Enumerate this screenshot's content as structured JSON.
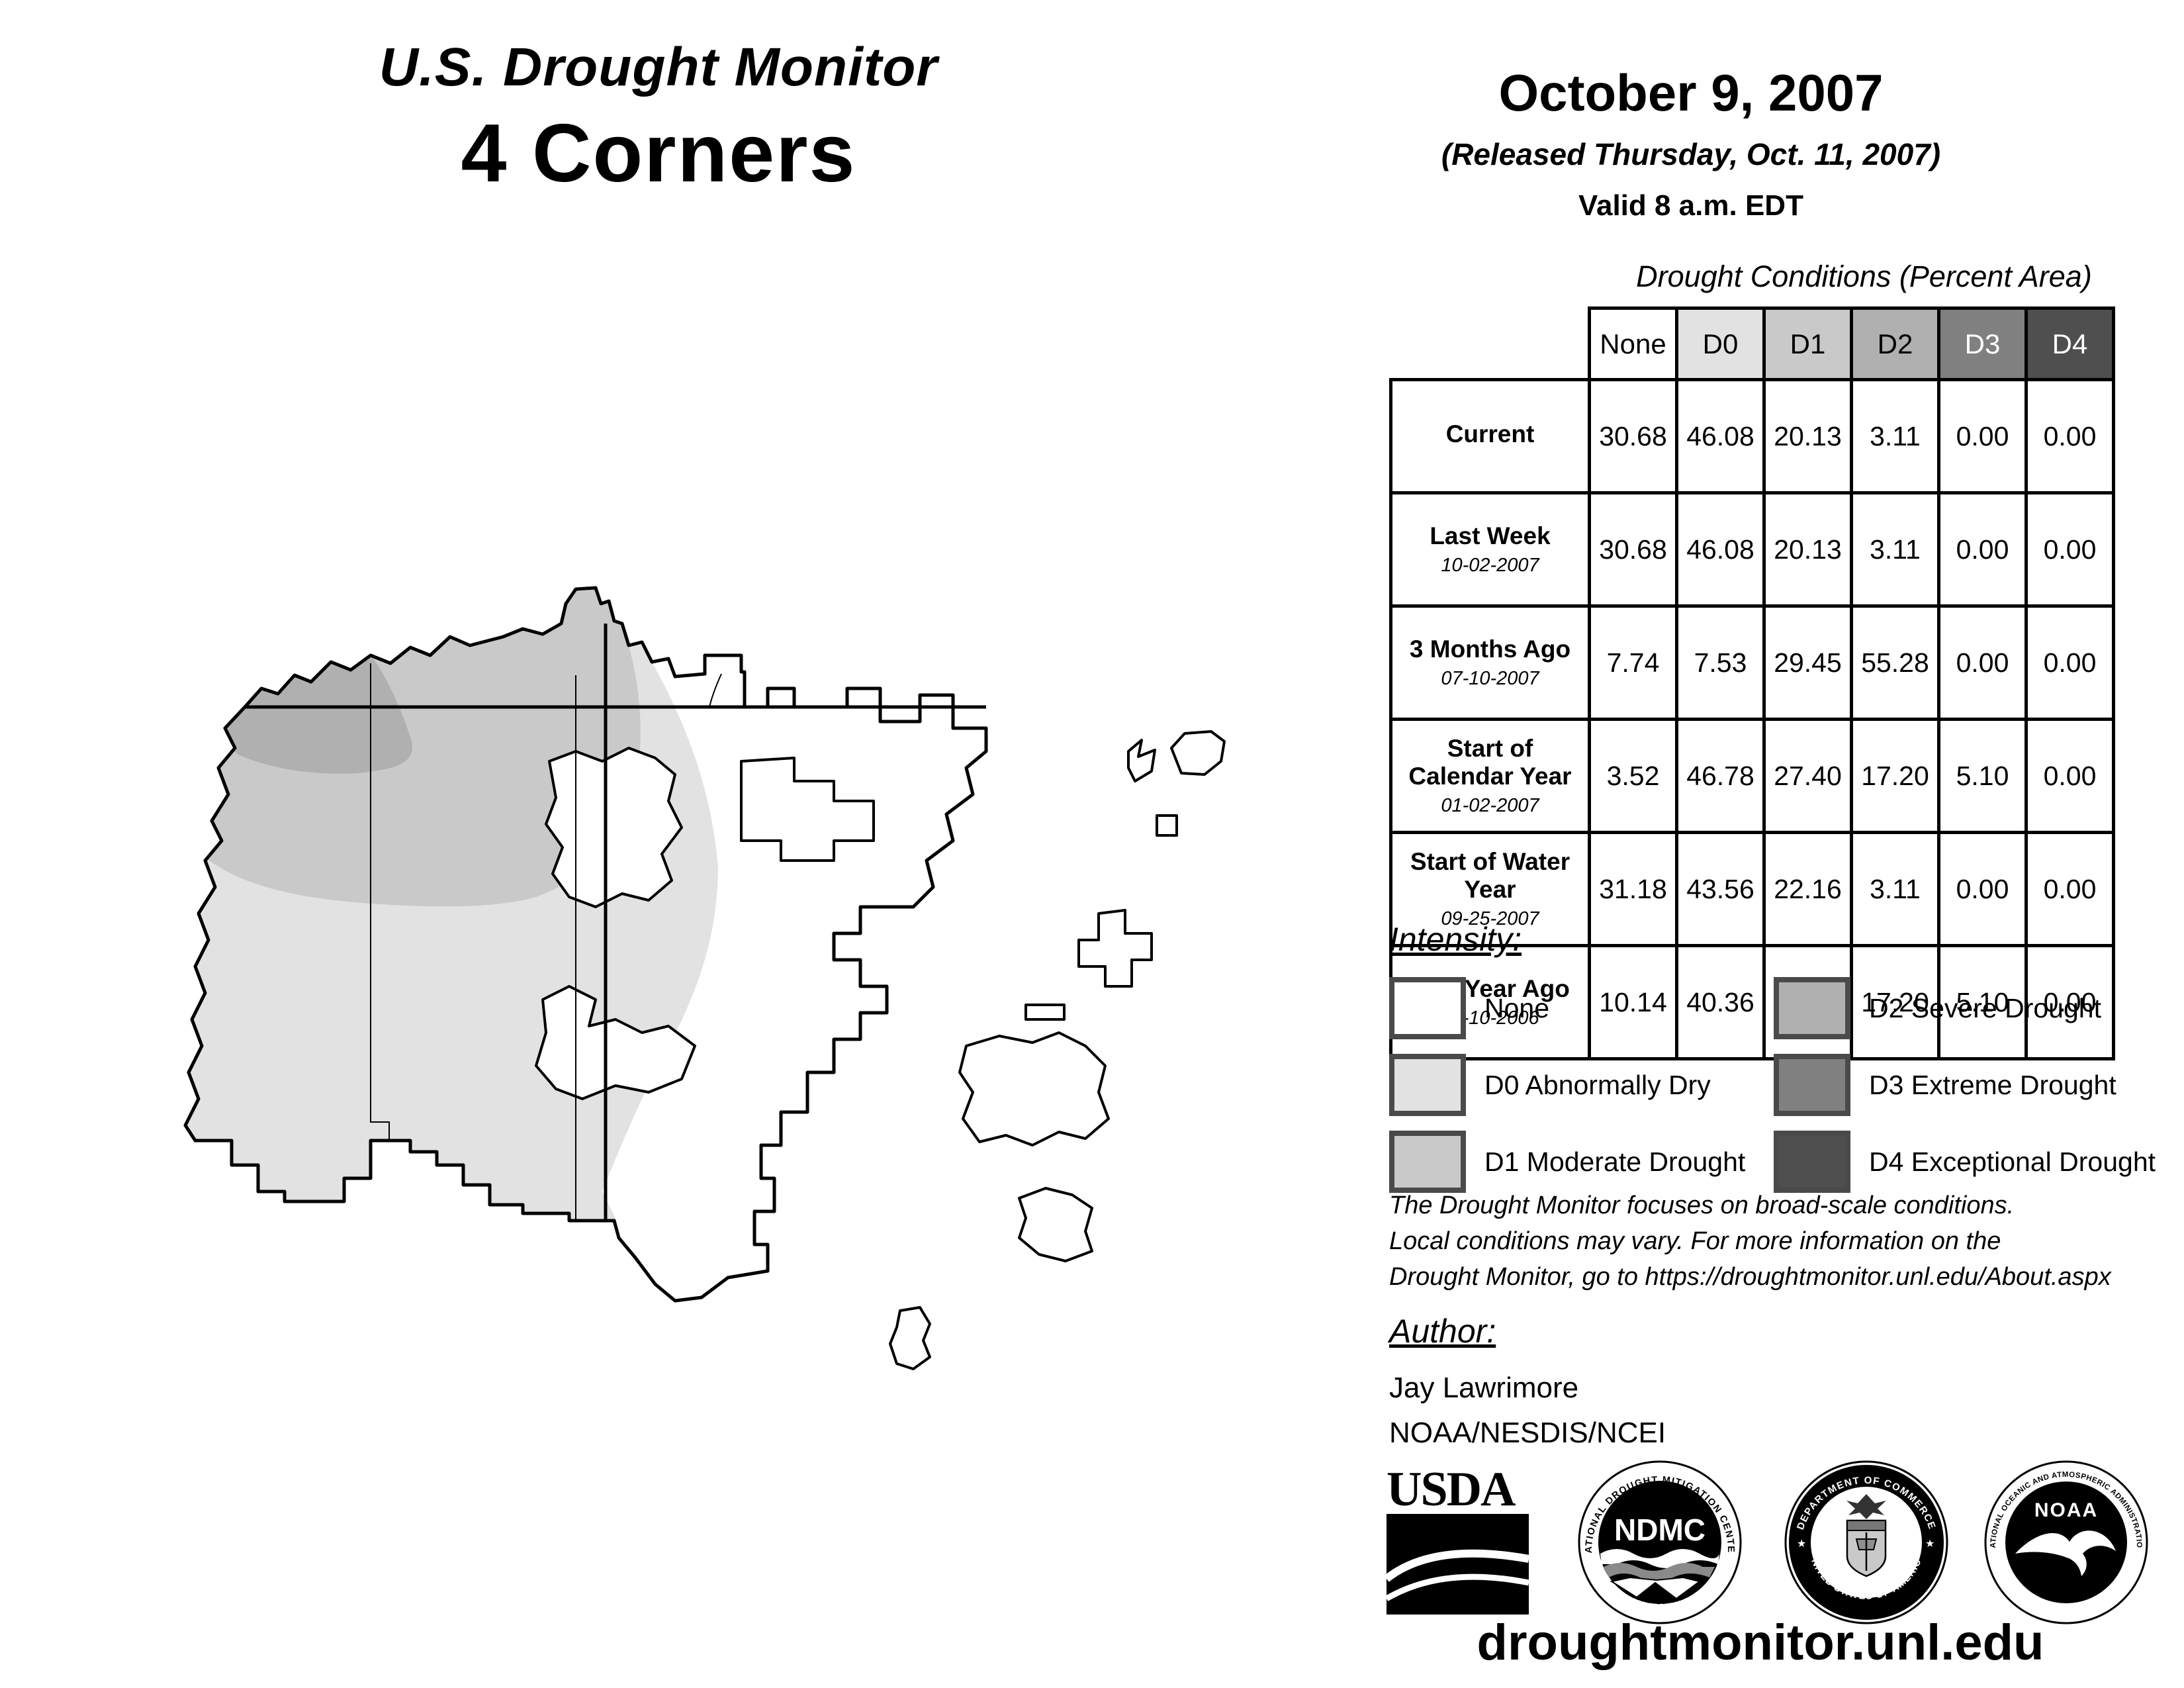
{
  "title": {
    "line1": "U.S. Drought Monitor",
    "line2": "4 Corners"
  },
  "header": {
    "date": "October 9, 2007",
    "released": "(Released Thursday, Oct. 11, 2007)",
    "valid": "Valid 8 a.m. EDT"
  },
  "table": {
    "title": "Drought Conditions (Percent Area)",
    "columns": [
      {
        "label": "None",
        "color": "#ffffff",
        "text_color": "#000000"
      },
      {
        "label": "D0",
        "color": "#e2e2e2",
        "text_color": "#000000"
      },
      {
        "label": "D1",
        "color": "#c9c9c9",
        "text_color": "#000000"
      },
      {
        "label": "D2",
        "color": "#b0b0b0",
        "text_color": "#000000"
      },
      {
        "label": "D3",
        "color": "#808080",
        "text_color": "#ffffff"
      },
      {
        "label": "D4",
        "color": "#4f4f4f",
        "text_color": "#ffffff"
      }
    ],
    "rows": [
      {
        "label": "Current",
        "sublabel": "",
        "values": [
          "30.68",
          "46.08",
          "20.13",
          "3.11",
          "0.00",
          "0.00"
        ]
      },
      {
        "label": "Last Week",
        "sublabel": "10-02-2007",
        "values": [
          "30.68",
          "46.08",
          "20.13",
          "3.11",
          "0.00",
          "0.00"
        ]
      },
      {
        "label": "3 Months Ago",
        "sublabel": "07-10-2007",
        "values": [
          "7.74",
          "7.53",
          "29.45",
          "55.28",
          "0.00",
          "0.00"
        ]
      },
      {
        "label": "Start of Calendar Year",
        "sublabel": "01-02-2007",
        "values": [
          "3.52",
          "46.78",
          "27.40",
          "17.20",
          "5.10",
          "0.00"
        ]
      },
      {
        "label": "Start of Water Year",
        "sublabel": "09-25-2007",
        "values": [
          "31.18",
          "43.56",
          "22.16",
          "3.11",
          "0.00",
          "0.00"
        ]
      },
      {
        "label": "One Year Ago",
        "sublabel": "10-10-2006",
        "values": [
          "10.14",
          "40.36",
          "27.21",
          "17.20",
          "5.10",
          "0.00"
        ]
      }
    ]
  },
  "legend": {
    "title": "Intensity:",
    "items": [
      {
        "label": "None",
        "color": "#ffffff"
      },
      {
        "label": "D0 Abnormally Dry",
        "color": "#e2e2e2"
      },
      {
        "label": "D1 Moderate Drought",
        "color": "#c9c9c9"
      },
      {
        "label": "D2 Severe Drought",
        "color": "#b0b0b0"
      },
      {
        "label": "D3 Extreme Drought",
        "color": "#808080"
      },
      {
        "label": "D4 Exceptional Drought",
        "color": "#4f4f4f"
      }
    ]
  },
  "notes": {
    "line1": "The Drought Monitor focuses on broad-scale conditions.",
    "line2": "Local conditions may vary. For more information on the",
    "line3": "Drought Monitor, go to https://droughtmonitor.unl.edu/About.aspx"
  },
  "author": {
    "title": "Author:",
    "name": "Jay Lawrimore",
    "org": "NOAA/NESDIS/NCEI"
  },
  "logos": {
    "usda": {
      "text": "USDA"
    },
    "ndmc": {
      "abbr": "NDMC",
      "top": "NATIONAL DROUGHT MITIGATION CENTER",
      "bottom": "UNIVERSITY OF NEBRASKA"
    },
    "commerce": {
      "top": "DEPARTMENT OF COMMERCE",
      "bottom": "UNITED STATES OF AMERICA"
    },
    "noaa": {
      "abbr": "NOAA",
      "top": "NATIONAL OCEANIC AND ATMOSPHERIC ADMINISTRATION",
      "bottom": "U.S. DEPARTMENT OF COMMERCE"
    }
  },
  "footer": {
    "url": "droughtmonitor.unl.edu"
  }
}
